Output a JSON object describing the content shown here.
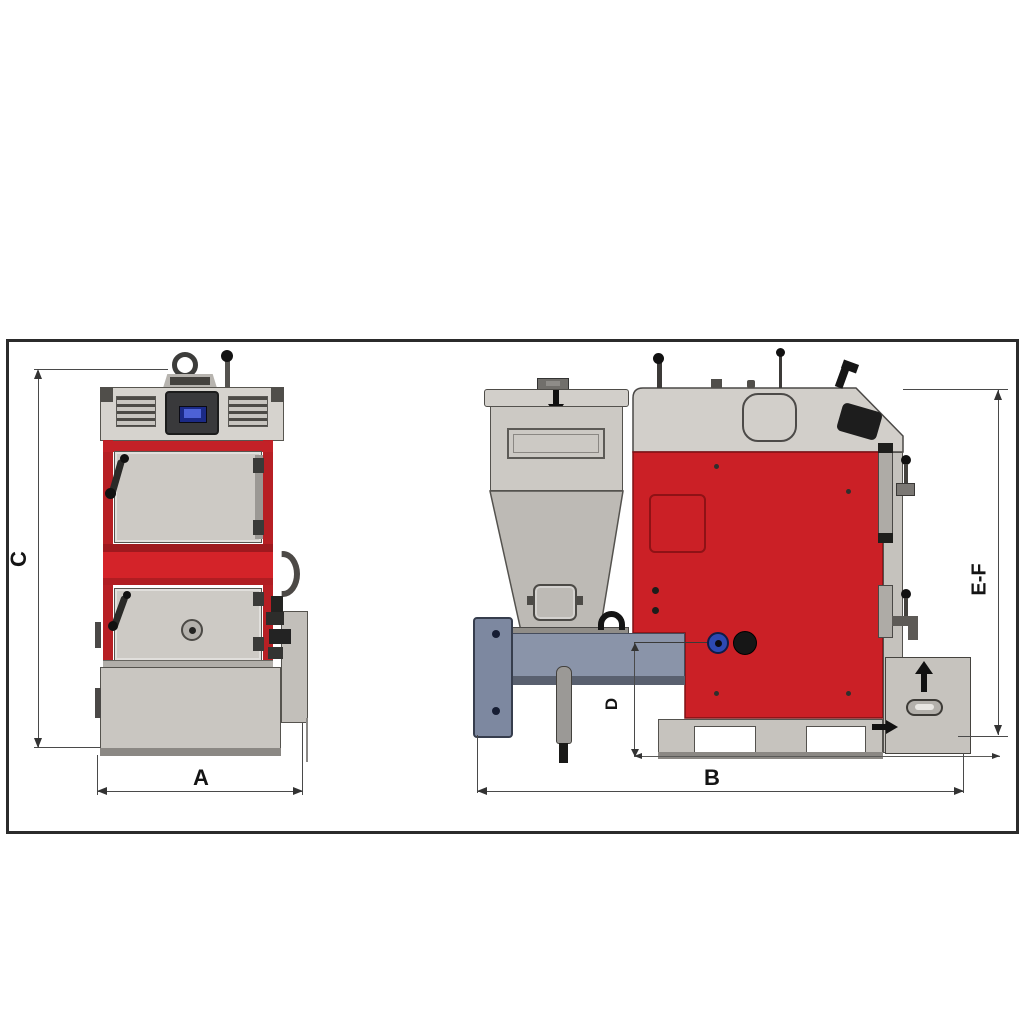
{
  "drawing": {
    "frame": {
      "style": "single-black-border"
    },
    "views": {
      "front_view": {
        "dimension_labels": {
          "height": "C",
          "width": "A"
        }
      },
      "side_view": {
        "dimension_labels": {
          "depth": "B",
          "feeder_axis_height": "D",
          "total_height": "E-F"
        }
      }
    },
    "icons": {
      "fuel_load_arrow": "down-arrow on hopper lid",
      "drawer_lift_arrow": "up-arrow on ash drawer",
      "drawer_out_arrow": "right-arrow at drawer side",
      "lifting_eye": "ring on boiler top"
    },
    "colors": {
      "boiler_red": "#cb2026",
      "mid_band_red": "#d42329",
      "panel_gray": "#cdcac5",
      "hopper_gray": "#ccc9c4",
      "feeder_blue_gray": "#8a94a9",
      "flange_blue_gray": "#7d88a0",
      "display_blue": "#3148c8",
      "port_blue": "#2d49b2",
      "outline": "#4a4a4a",
      "frame_border": "#2b2b2b"
    }
  }
}
